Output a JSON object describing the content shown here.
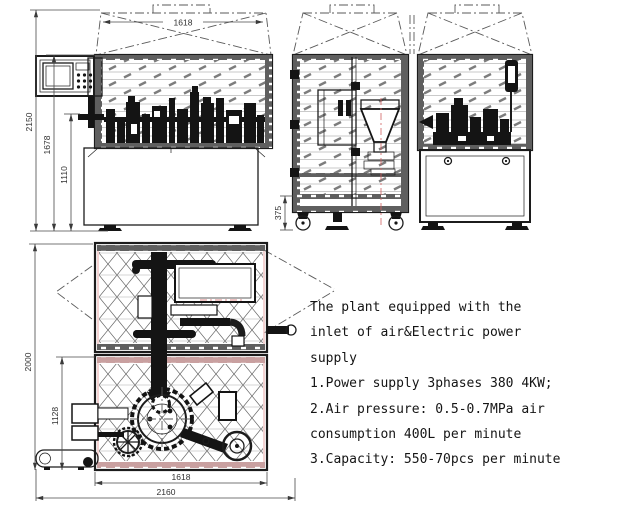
{
  "drawing": {
    "title": "machine general arrangement drawing",
    "notes": {
      "lines": [
        "The plant equipped with the",
        "inlet of air&Electric power",
        "supply",
        "1.Power supply 3phases 380 4KW;",
        "2.Air pressure: 0.5-0.7MPa air",
        "consumption 400L per minute",
        "3.Capacity: 550-70pcs per minute"
      ]
    },
    "dimensions": {
      "front_width": "1618",
      "front_height_overall": "2150",
      "front_height_enclosure": "1678",
      "front_height_table": "1110",
      "side_base_height": "375",
      "plan_depth_overall": "2000",
      "plan_depth_lower": "1128",
      "plan_width_inner": "1618",
      "plan_width_overall": "2160"
    },
    "colors": {
      "line": "#1c1c1c",
      "hatch_gray": "#7d7d7d",
      "band_gray": "#5f5f5f",
      "accent_pink": "#efc0c0",
      "accent_red": "#d06060",
      "background": "#ffffff"
    }
  }
}
